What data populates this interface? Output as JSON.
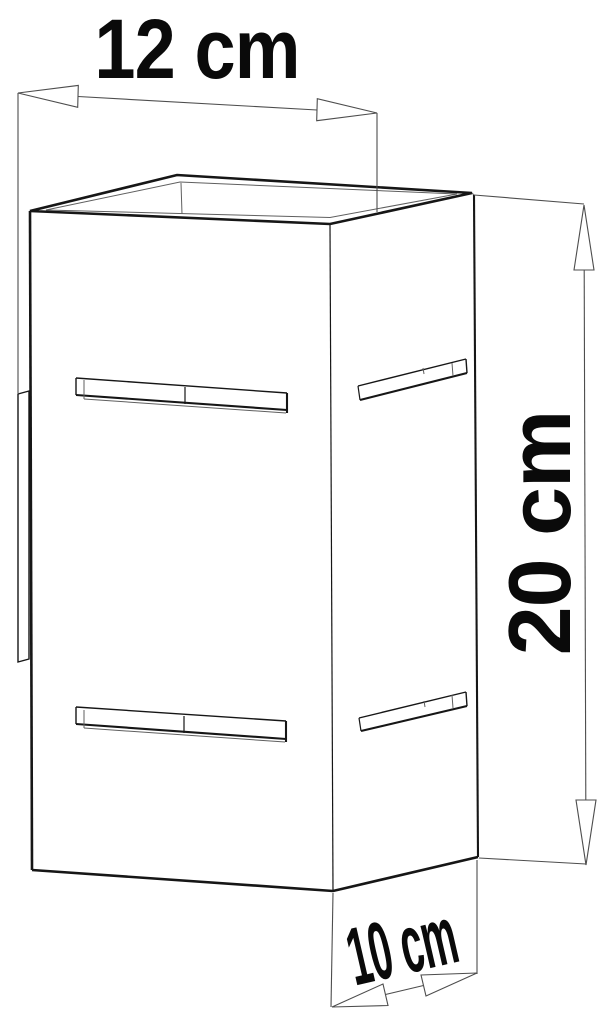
{
  "diagram": {
    "type": "product-dimension-drawing",
    "subject": "rectangular wall lamp with horizontal vent slots, open top and wall-mount plate",
    "dimensions": {
      "width": {
        "label": "12 cm",
        "value_cm": 12
      },
      "height": {
        "label": "20 cm",
        "value_cm": 20
      },
      "depth": {
        "label": "10 cm",
        "value_cm": 10
      }
    },
    "colors": {
      "background": "#ffffff",
      "outline": "#161616",
      "thin_line": "#5f5f5f",
      "dimension_line": "#4d4d4d",
      "text": "#0a0a0a"
    }
  }
}
